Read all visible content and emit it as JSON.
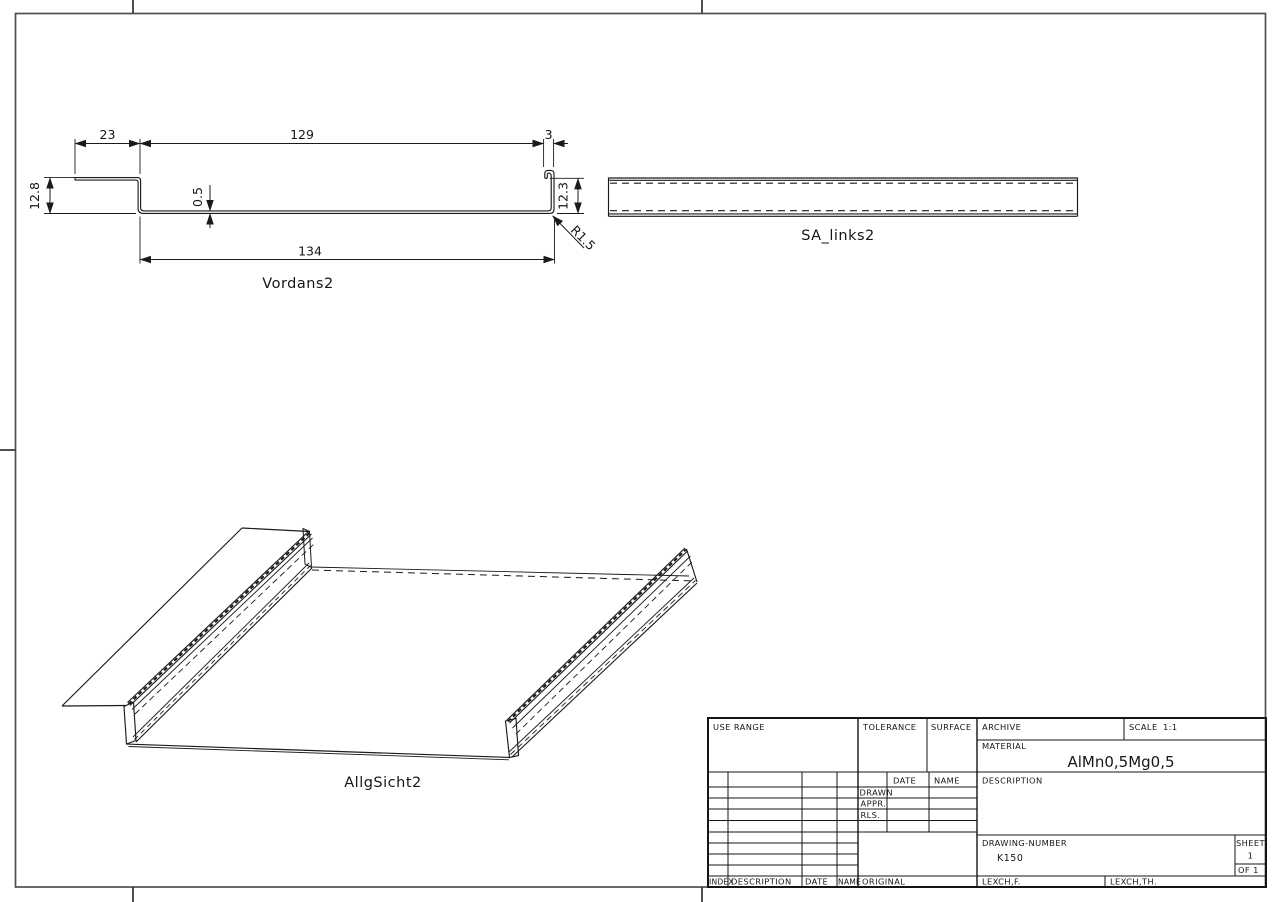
{
  "views": {
    "front": {
      "label": "Vordans2",
      "dims": {
        "top_left": "23",
        "top_mid": "129",
        "top_right": "3",
        "left_height": "12.8",
        "thickness": "0.5",
        "bottom_width": "134",
        "right_height": "12.3",
        "radius": "R1.5"
      }
    },
    "side": {
      "label": "SA_links2"
    },
    "iso": {
      "label": "AllgSicht2"
    }
  },
  "title_block": {
    "use_range_label": "USE RANGE",
    "tolerance_label": "TOLERANCE",
    "surface_label": "SURFACE",
    "archive_label": "ARCHIVE",
    "scale_label": "SCALE",
    "scale_value": "1:1",
    "material_label": "MATERIAL",
    "material_value": "AlMn0,5Mg0,5",
    "description_label": "DESCRIPTION",
    "date_header": "DATE",
    "name_header": "NAME",
    "drawn_label": "DRAWN",
    "appr_label": "APPR.",
    "rls_label": "RLS.",
    "drawing_number_label": "DRAWING-NUMBER",
    "drawing_number_value": "K150",
    "sheet_label": "SHEET",
    "sheet_value": "1",
    "of_value": "OF 1",
    "index_col": "INDEX",
    "description_col": "DESCRIPTION",
    "date_col": "DATE",
    "name_col": "NAME",
    "original_col": "ORIGINAL",
    "lexch_f_col": "LEXCH,F.",
    "lexch_th_col": "LEXCH,TH."
  },
  "colors": {
    "line": "#1b1b1b",
    "frame": "#4f4f4f",
    "background": "#ffffff"
  }
}
